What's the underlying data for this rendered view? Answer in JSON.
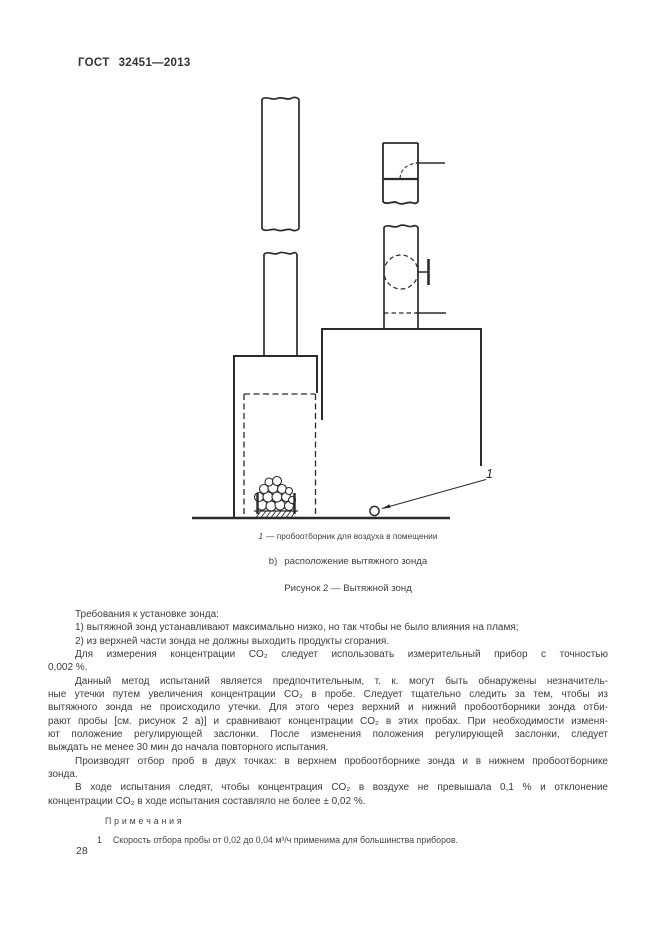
{
  "page": {
    "header_label": "ГОСТ",
    "header_number": "32451—2013",
    "page_number": "28"
  },
  "figure": {
    "callout_label": "1",
    "key_num": "1",
    "key_text": "— пробоотборник для воздуха в помещении",
    "sub_label": "b)",
    "sub_title": "расположение вытяжного зонда",
    "caption": "Рисунок 2 — Вытяжной зонд"
  },
  "body": {
    "lines": [
      "Требования к установке зонда:",
      "1) вытяжной зонд устанавливают максимально низко, но так чтобы не было влияния на пламя;",
      "2) из верхней части зонда не должны выходить продукты сгорания.",
      "Для измерения концентрации CO₂ следует использовать измерительный прибор с точностью",
      "0,002 %.",
      "Данный метод испытаний является предпочтительным, т. к. могут быть обнаружены незначитель-",
      "ные утечки путем увеличения концентрации CO₂ в пробе. Следует тщательно следить за тем, чтобы из",
      "вытяжного зонда не происходило утечки. Для этого через верхний и нижний пробоотборники зонда отби-",
      "рают пробы [см. рисунок 2 а)] и сравнивают концентрации CO₂ в этих пробах. При необходимости изменя-",
      "ют положение регулирующей заслонки. После изменения положения регулирующей заслонки, следует",
      "выждать не менее 30 мин до начала повторного испытания.",
      "Производят отбор проб в двух точках: в верхнем пробоотборнике зонда и в нижнем пробоотборнике",
      "зонда.",
      "В ходе испытания следят, чтобы концентрация CO₂ в воздухе не превышала 0,1 % и отклонение",
      "концентрации CO₂ в ходе испытания составляло не более ± 0,02 %."
    ],
    "notes_heading": "П р и м е ч а н и я",
    "note1_num": "1",
    "note1_text": "Скорость отбора пробы от 0,02 до 0,04 м³/ч применима для большинства приборов."
  },
  "colors": {
    "text": "#3d3d3d",
    "line": "#2b2b2b",
    "background": "#ffffff"
  }
}
